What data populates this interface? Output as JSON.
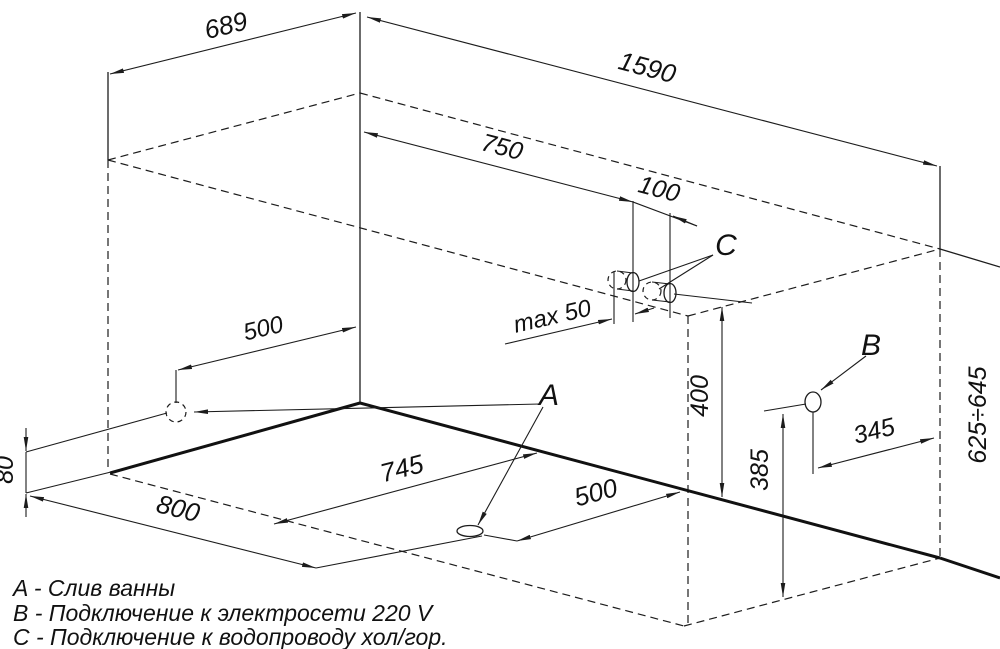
{
  "drawing": {
    "dims": {
      "top_width": "689",
      "length": "1590",
      "c_offset": "750",
      "c_spacing": "100",
      "c_protrusion": "max 50",
      "wall_drain_offset": "500",
      "c_height": "400",
      "b_height": "385",
      "b_offset": "345",
      "tub_height_range": "625÷645",
      "wall_drain_height": "80",
      "drain_left_offset": "800",
      "drain_depth_offset": "745",
      "drain_right_offset": "500"
    },
    "markers": {
      "a": "A",
      "b": "B",
      "c": "C"
    },
    "legend": {
      "line_a": "A - Слив ванны",
      "line_b": "B - Подключение к электросети 220 V",
      "line_c": "C - Подключение к водопроводу хол/гор."
    },
    "colors": {
      "line": "#1c1c1c",
      "background": "#ffffff"
    }
  }
}
